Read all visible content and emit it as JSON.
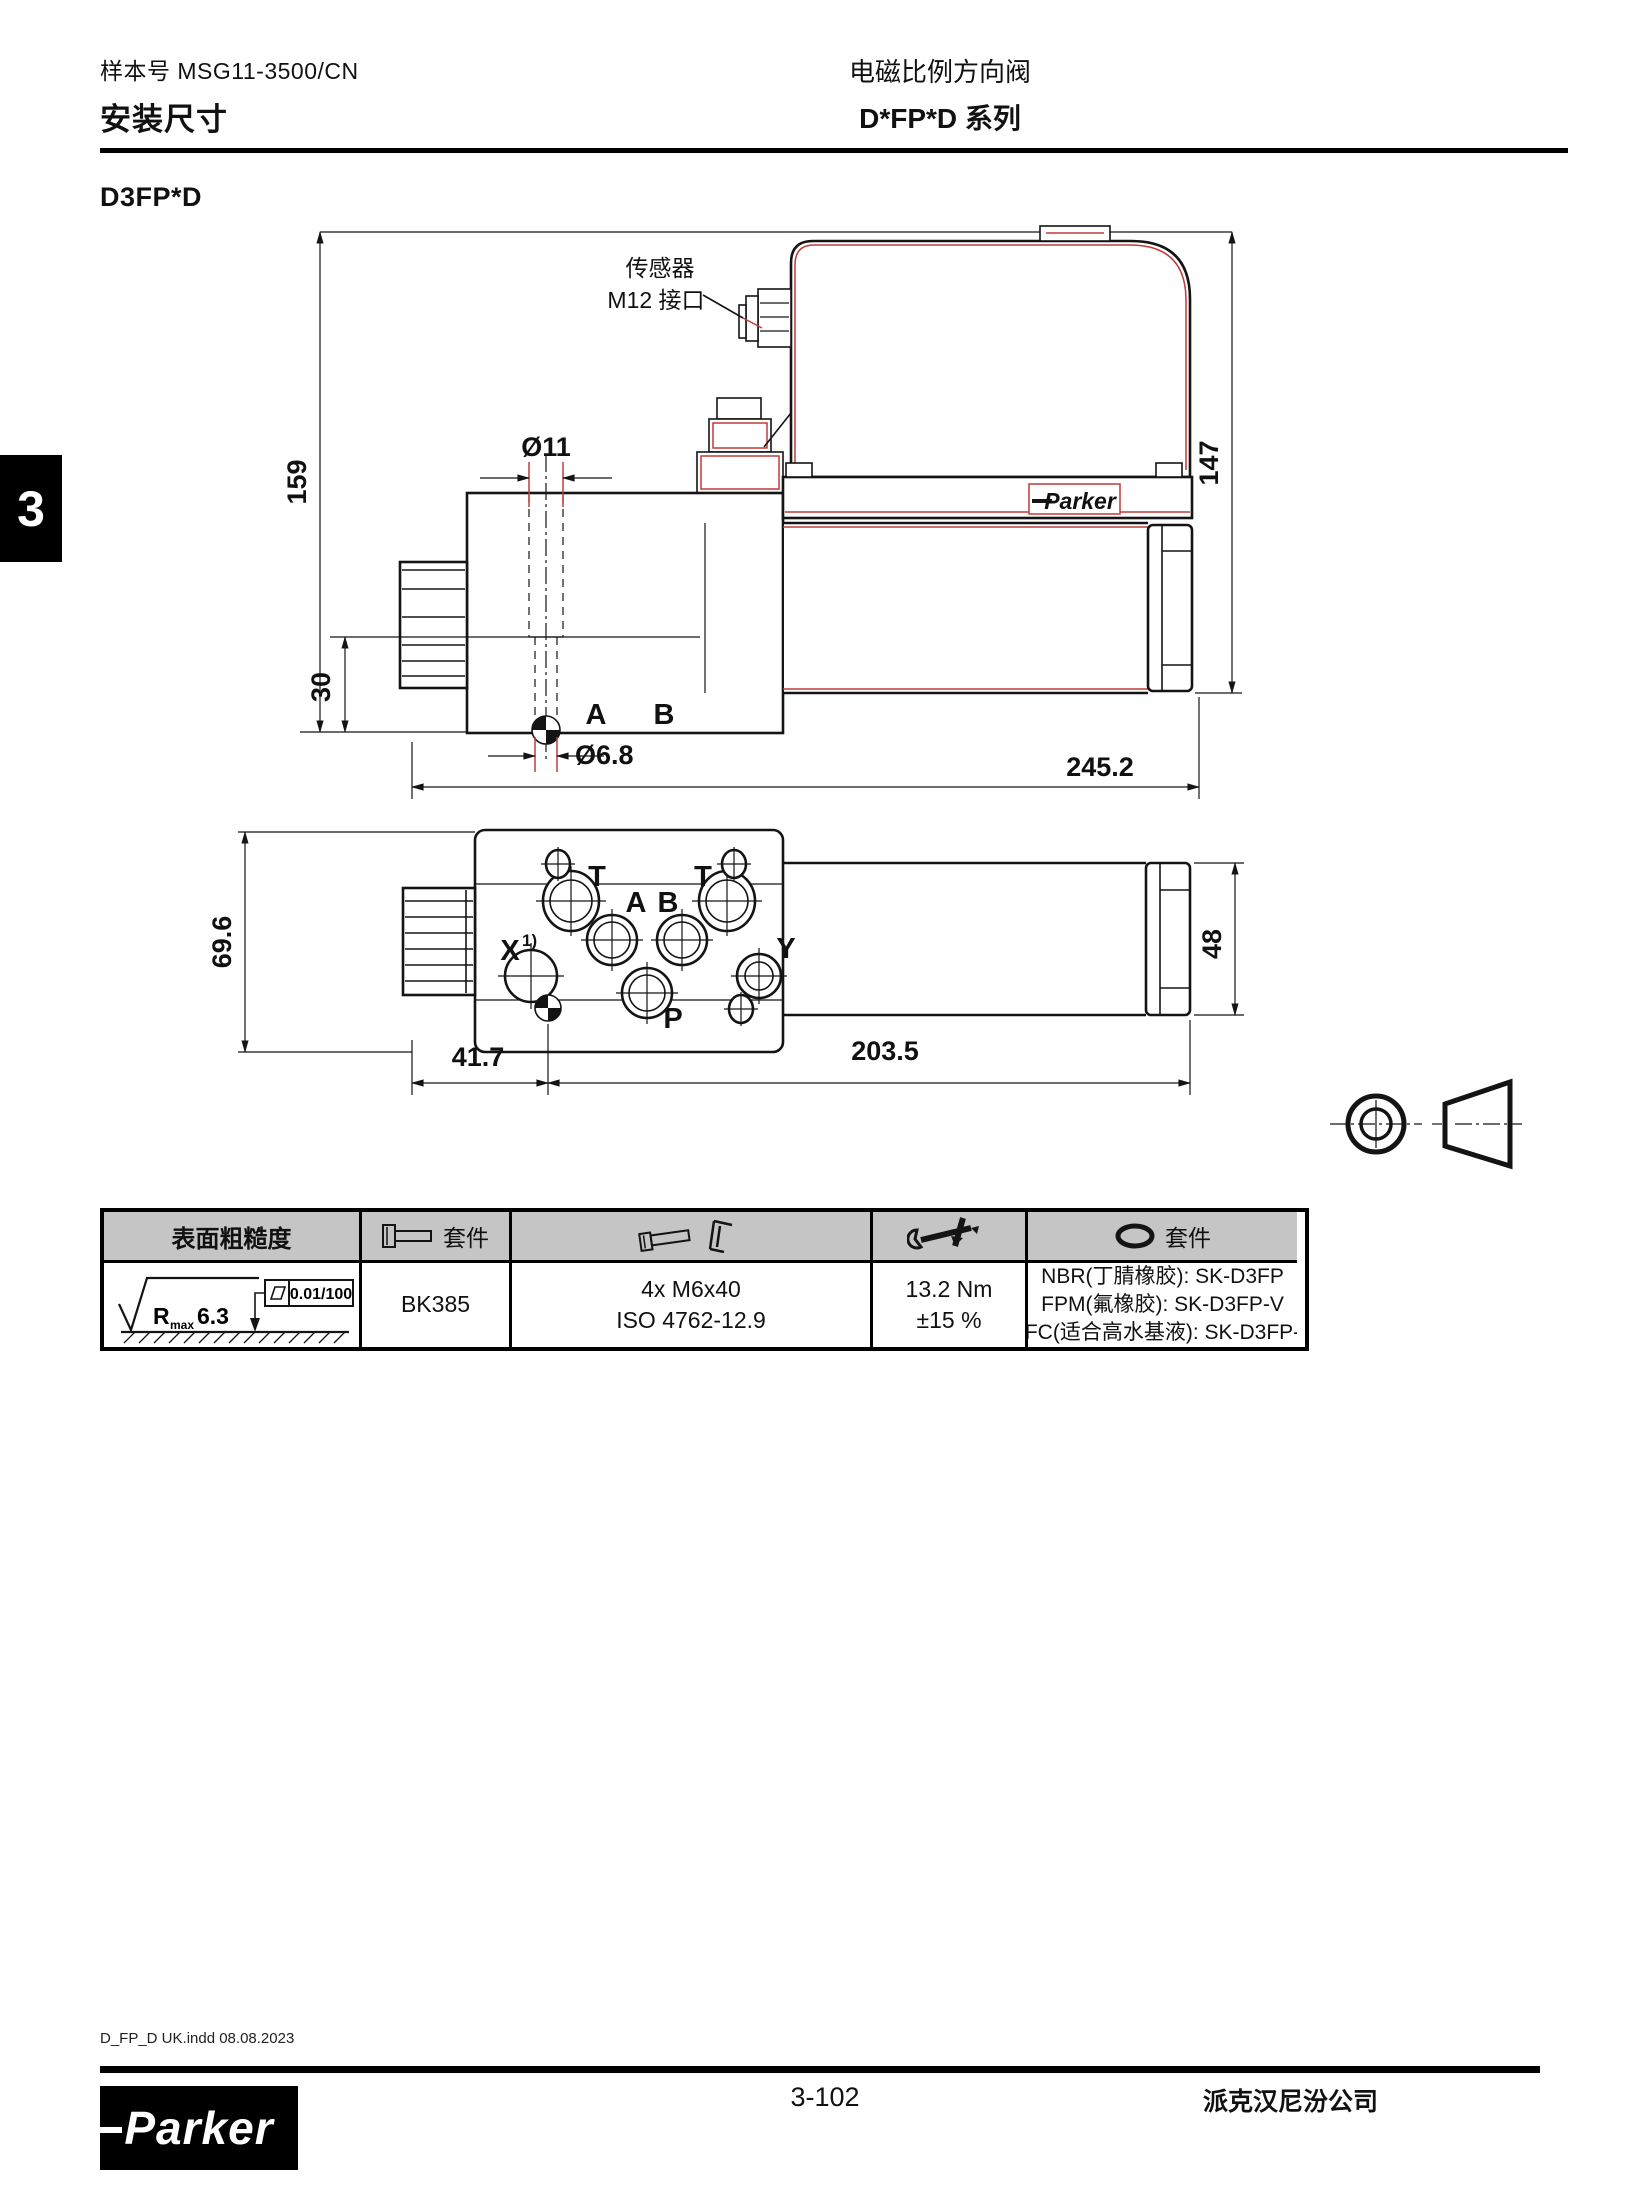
{
  "header": {
    "doc_no": "样本号 MSG11-3500/CN",
    "title_left": "安装尺寸",
    "title_right_line1": "电磁比例方向阀",
    "title_right_line2": "D*FP*D 系列"
  },
  "section": {
    "model": "D3FP*D"
  },
  "side_tab": {
    "number": "3"
  },
  "drawing": {
    "sensor_label_line1": "传感器",
    "sensor_label_line2": "M12 接口",
    "brand": "Parker",
    "dims": {
      "overall_height": "159",
      "solenoid_height": "147",
      "hole_depth": "30",
      "overall_length": "245.2",
      "counterbore_dia": "Ø11",
      "hole_dia": "Ø6.8",
      "body_width": "69.6",
      "solenoid_dia": "48",
      "port_offset": "41.7",
      "tube_length": "203.5"
    },
    "ports": {
      "t_left": "T",
      "t_right": "T",
      "a": "A",
      "b": "B",
      "x": "X",
      "x_sup": "1)",
      "y": "Y",
      "p": "P",
      "side_a": "A",
      "side_b": "B"
    }
  },
  "table": {
    "col1_header": "表面粗糙度",
    "col2_header": "套件",
    "col5_header": "套件",
    "roughness_r": "R",
    "roughness_sub": "max",
    "roughness_value": "6.3",
    "flatness_value": "0.01/100",
    "bolt_kit": "BK385",
    "screws_line1": "4x M6x40",
    "screws_line2": "ISO 4762-12.9",
    "torque_line1": "13.2 Nm",
    "torque_line2": "±15 %",
    "seal_line1": "NBR(丁腈橡胶): SK-D3FP",
    "seal_line2": "FPM(氟橡胶): SK-D3FP-V",
    "seal_line3": "HFC(适合高水基液): SK-D3FP-H"
  },
  "footer": {
    "file_info": "D_FP_D UK.indd 08.08.2023",
    "page_number": "3-102",
    "company": "派克汉尼汾公司",
    "brand": "Parker"
  },
  "colors": {
    "accent_red": "#c03a3a",
    "header_gray": "#c5c5c5"
  }
}
